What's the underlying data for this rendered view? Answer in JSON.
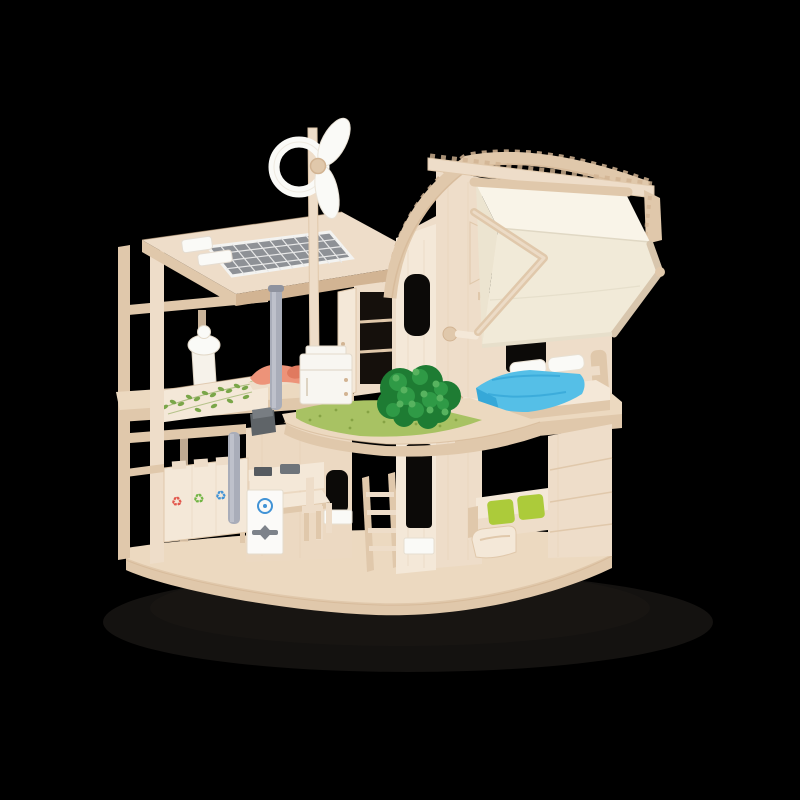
{
  "image": {
    "type": "product-photo",
    "background_color": "#000000",
    "alt": "Wooden eco dollhouse toy photographed on a black background",
    "description": "A two-storey natural-wood toy dollhouse (eco / green living theme) shown in three-quarter view on a plain black background. The left wing is an open post-and-beam frame with a slanted roof carrying a gray solar panel and a white wind turbine on a tall pole. The right wing has an arched plywood roof with a folded ivory canvas awning hanging off its right side. Furnishings include an upstairs bed with a bright blue blanket and white pillows, a coral lounger, a white battery/fridge cabinet, a green felt grass mat with a dark-green shrub on the middle balcony, a kitchen table with chairs, a recycling station with red, green and blue recycle symbols, a white compost unit with a blue icon, a gray rain downpipe, a green vine decal on the balcony wall, a white toilet fixture, and a sofa with two lime-green cushions beside a wooden armchair on a rounded wooden base."
  },
  "text_in_image": "none",
  "objects": {
    "dollhouse": {
      "label": "Wooden green dollhouse with furniture"
    },
    "shadow": {
      "label": "Soft floor shadow"
    },
    "base": {
      "label": "Rounded wooden base platform",
      "color": "#ecd9c0"
    },
    "left_wing": {
      "label": "Open-frame left wing with slanted roof"
    },
    "solar_panel": {
      "label": "Rooftop solar panel",
      "color": "#8e9196"
    },
    "water_heater": {
      "label": "White rooftop water heater boxes",
      "color": "#fafaf7"
    },
    "wind_turbine": {
      "label": "White wind turbine on pole",
      "color": "#fafaf7"
    },
    "toilet": {
      "label": "White toilet fixture",
      "color": "#fafaf7"
    },
    "vine": {
      "label": "Green vine decal on balcony wall",
      "color": "#7aa649"
    },
    "recycling_station": {
      "label": "Recycling station with red, green and blue recycle symbols",
      "colors": [
        "#e2574c",
        "#71b544",
        "#4193d6"
      ]
    },
    "compost_unit": {
      "label": "White compost / water unit with blue icon",
      "color": "#4193d6"
    },
    "rain_pipe": {
      "label": "Gray rain downpipe",
      "color": "#a9adb9"
    },
    "kitchen": {
      "label": "Kitchen counter, table and chairs"
    },
    "ladder": {
      "label": "Wooden ladder"
    },
    "wardrobe": {
      "label": "Wardrobe with open door"
    },
    "battery_cabinet": {
      "label": "White battery / fridge cabinet",
      "color": "#f8f6f1"
    },
    "lounger": {
      "label": "Coral lounger",
      "color": "#ed9379"
    },
    "balcony": {
      "label": "Curved balcony deck"
    },
    "grass_mat": {
      "label": "Green felt grass mat",
      "color": "#a8c263"
    },
    "bush": {
      "label": "Dark green felt shrub",
      "color": "#1e7c33"
    },
    "right_wing": {
      "label": "Right wing with arched roof"
    },
    "arched_roof": {
      "label": "Curved laminated roof"
    },
    "awning": {
      "label": "Folded ivory canvas awning",
      "color": "#f1ead8"
    },
    "bed": {
      "label": "Bed with blue blanket and white pillows",
      "color": "#55bfe7"
    },
    "paneled_wall": {
      "label": "Paneled lower right wall"
    },
    "sofa": {
      "label": "Sofa with lime-green cushions",
      "color": "#accb3a"
    },
    "armchair": {
      "label": "Wooden armchair"
    },
    "windows": {
      "label": "Window openings with white planter boxes"
    }
  },
  "palette": {
    "bg": "#000000",
    "wood-lightest": "#f4e8d8",
    "wood-light": "#eeddc9",
    "wood-warm": "#ecd9c2",
    "wood-mid": "#e0c8ab",
    "wood-dark": "#d2b493",
    "wood-deep": "#bf9c79",
    "floor-light": "#ecd9c0",
    "solar-gray": "#8e9196",
    "white": "#fafaf7",
    "canvas-1": "#f9f4e8",
    "canvas-2": "#f1ead8",
    "canvas-3": "#ece4d0",
    "grass": "#a8c263",
    "grass-dot": "#86a344",
    "bush-dark": "#1e7c33",
    "bush-mid": "#2f9a46",
    "bush-light": "#57b35f",
    "blanket": "#55bfe7",
    "blanket-dark": "#36a8d8",
    "coral": "#ed9379",
    "coral-dark": "#e07a5f",
    "lime": "#accb3a",
    "pipe": "#a9adb9",
    "steel": "#7d828a",
    "icon-red": "#e2574c",
    "icon-green": "#71b544",
    "icon-blue": "#4193d6",
    "opening": "#0c0a08",
    "shadow": "#141210"
  }
}
